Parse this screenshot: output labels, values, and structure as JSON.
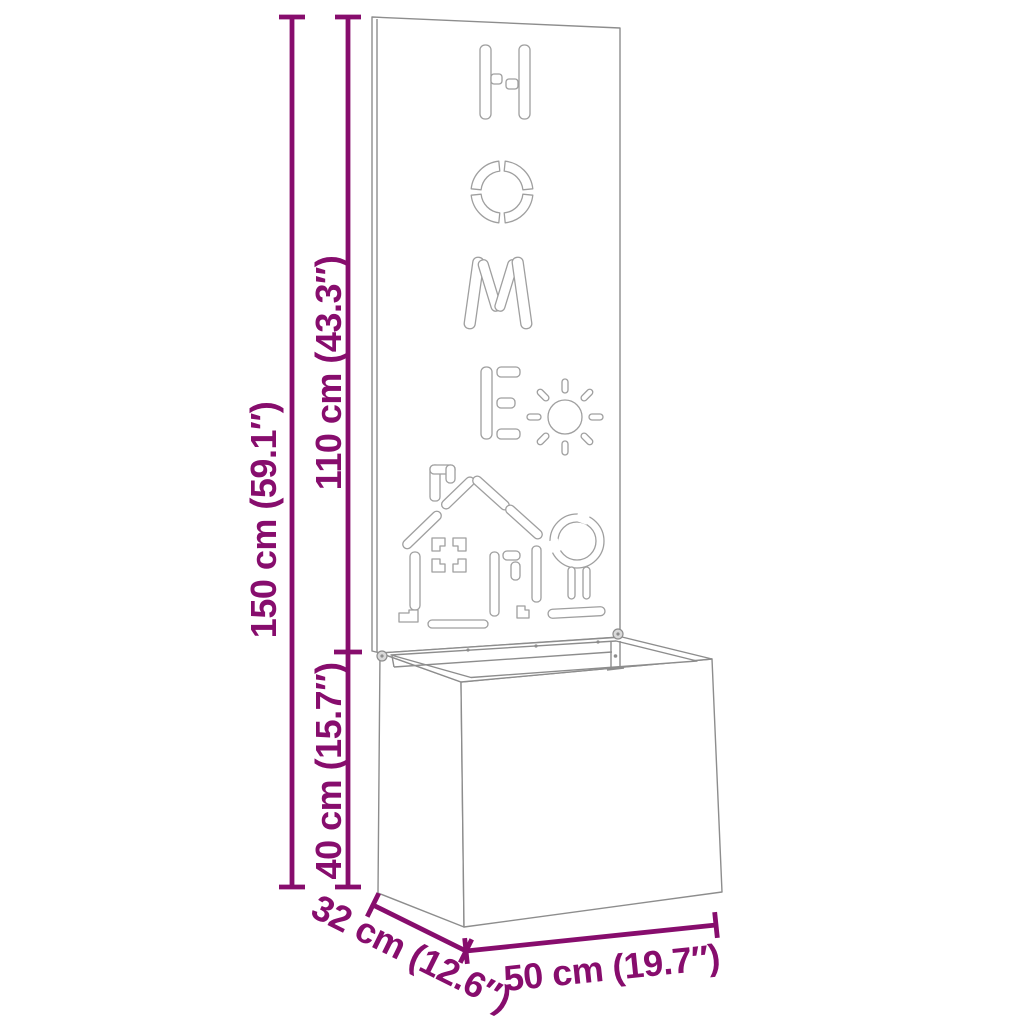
{
  "diagram": {
    "type": "product-dimension-diagram",
    "product": "Planter box with decorative HOME back panel",
    "panel_word": "HOME",
    "accent_color": "#870d6d",
    "artwork_line_color": "#8d8d8d",
    "cutout_line_color": "#9f9f9f",
    "background_color": "#ffffff",
    "dimensions": {
      "total_height": "150 cm (59.1″)",
      "panel_height": "110 cm (43.3″)",
      "box_height": "40 cm (15.7″)",
      "depth": "32 cm (12.6″)",
      "width": "50 cm (19.7″)"
    },
    "cutout_motifs": [
      "letter-H",
      "letter-O",
      "letter-M",
      "letter-E",
      "sun",
      "house",
      "tree"
    ]
  }
}
